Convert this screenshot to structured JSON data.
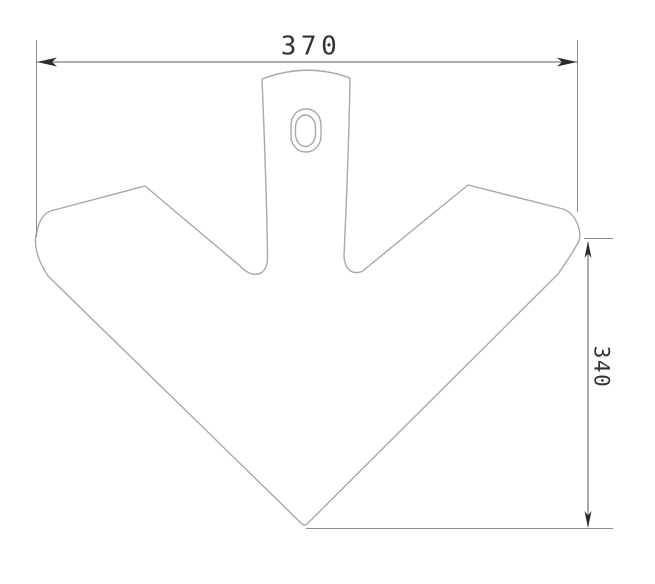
{
  "drawing": {
    "dimensions": {
      "width_label": "370",
      "height_label": "340"
    },
    "colors": {
      "background": "#ffffff",
      "part-outline": "#a8a8a8",
      "extension-line": "#8c8c8c",
      "dimension-line": "#5a5a5a",
      "marker": "#2b2b2b",
      "text": "#333333"
    }
  }
}
